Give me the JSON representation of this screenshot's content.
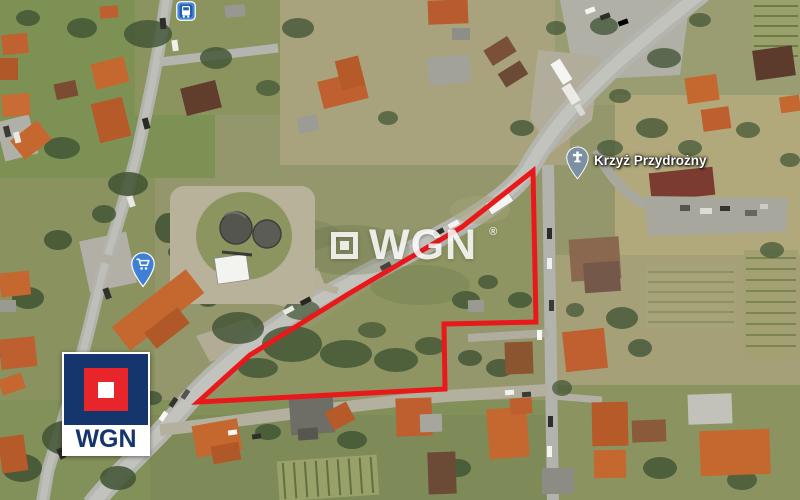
{
  "meta": {
    "description": "Aerial satellite photo of a land parcel outlined in red (real-estate listing image)",
    "width_px": 800,
    "height_px": 500
  },
  "watermark": {
    "text": "WGN",
    "registered_mark": "®"
  },
  "brand_logo": {
    "text": "WGN"
  },
  "map": {
    "poi": {
      "label": "Krzyż Przydrożny"
    },
    "markers": {
      "bus_stop": {
        "type": "bus-stop"
      },
      "shop": {
        "type": "shopping-cart-pin"
      }
    }
  },
  "parcel": {
    "outline_color": "#e9191b",
    "outline_stroke_px": 5,
    "outline_points": "533,171 536,322 444,324 445,389 198,402 250,355 350,293 462,227"
  },
  "colors": {
    "outline_red": "#e9191b",
    "logo_navy": "#15356d",
    "logo_red": "#e8252a",
    "marker_blue": "#4a8ad4",
    "poi_pin_gray_blue": "#7b90a3"
  }
}
